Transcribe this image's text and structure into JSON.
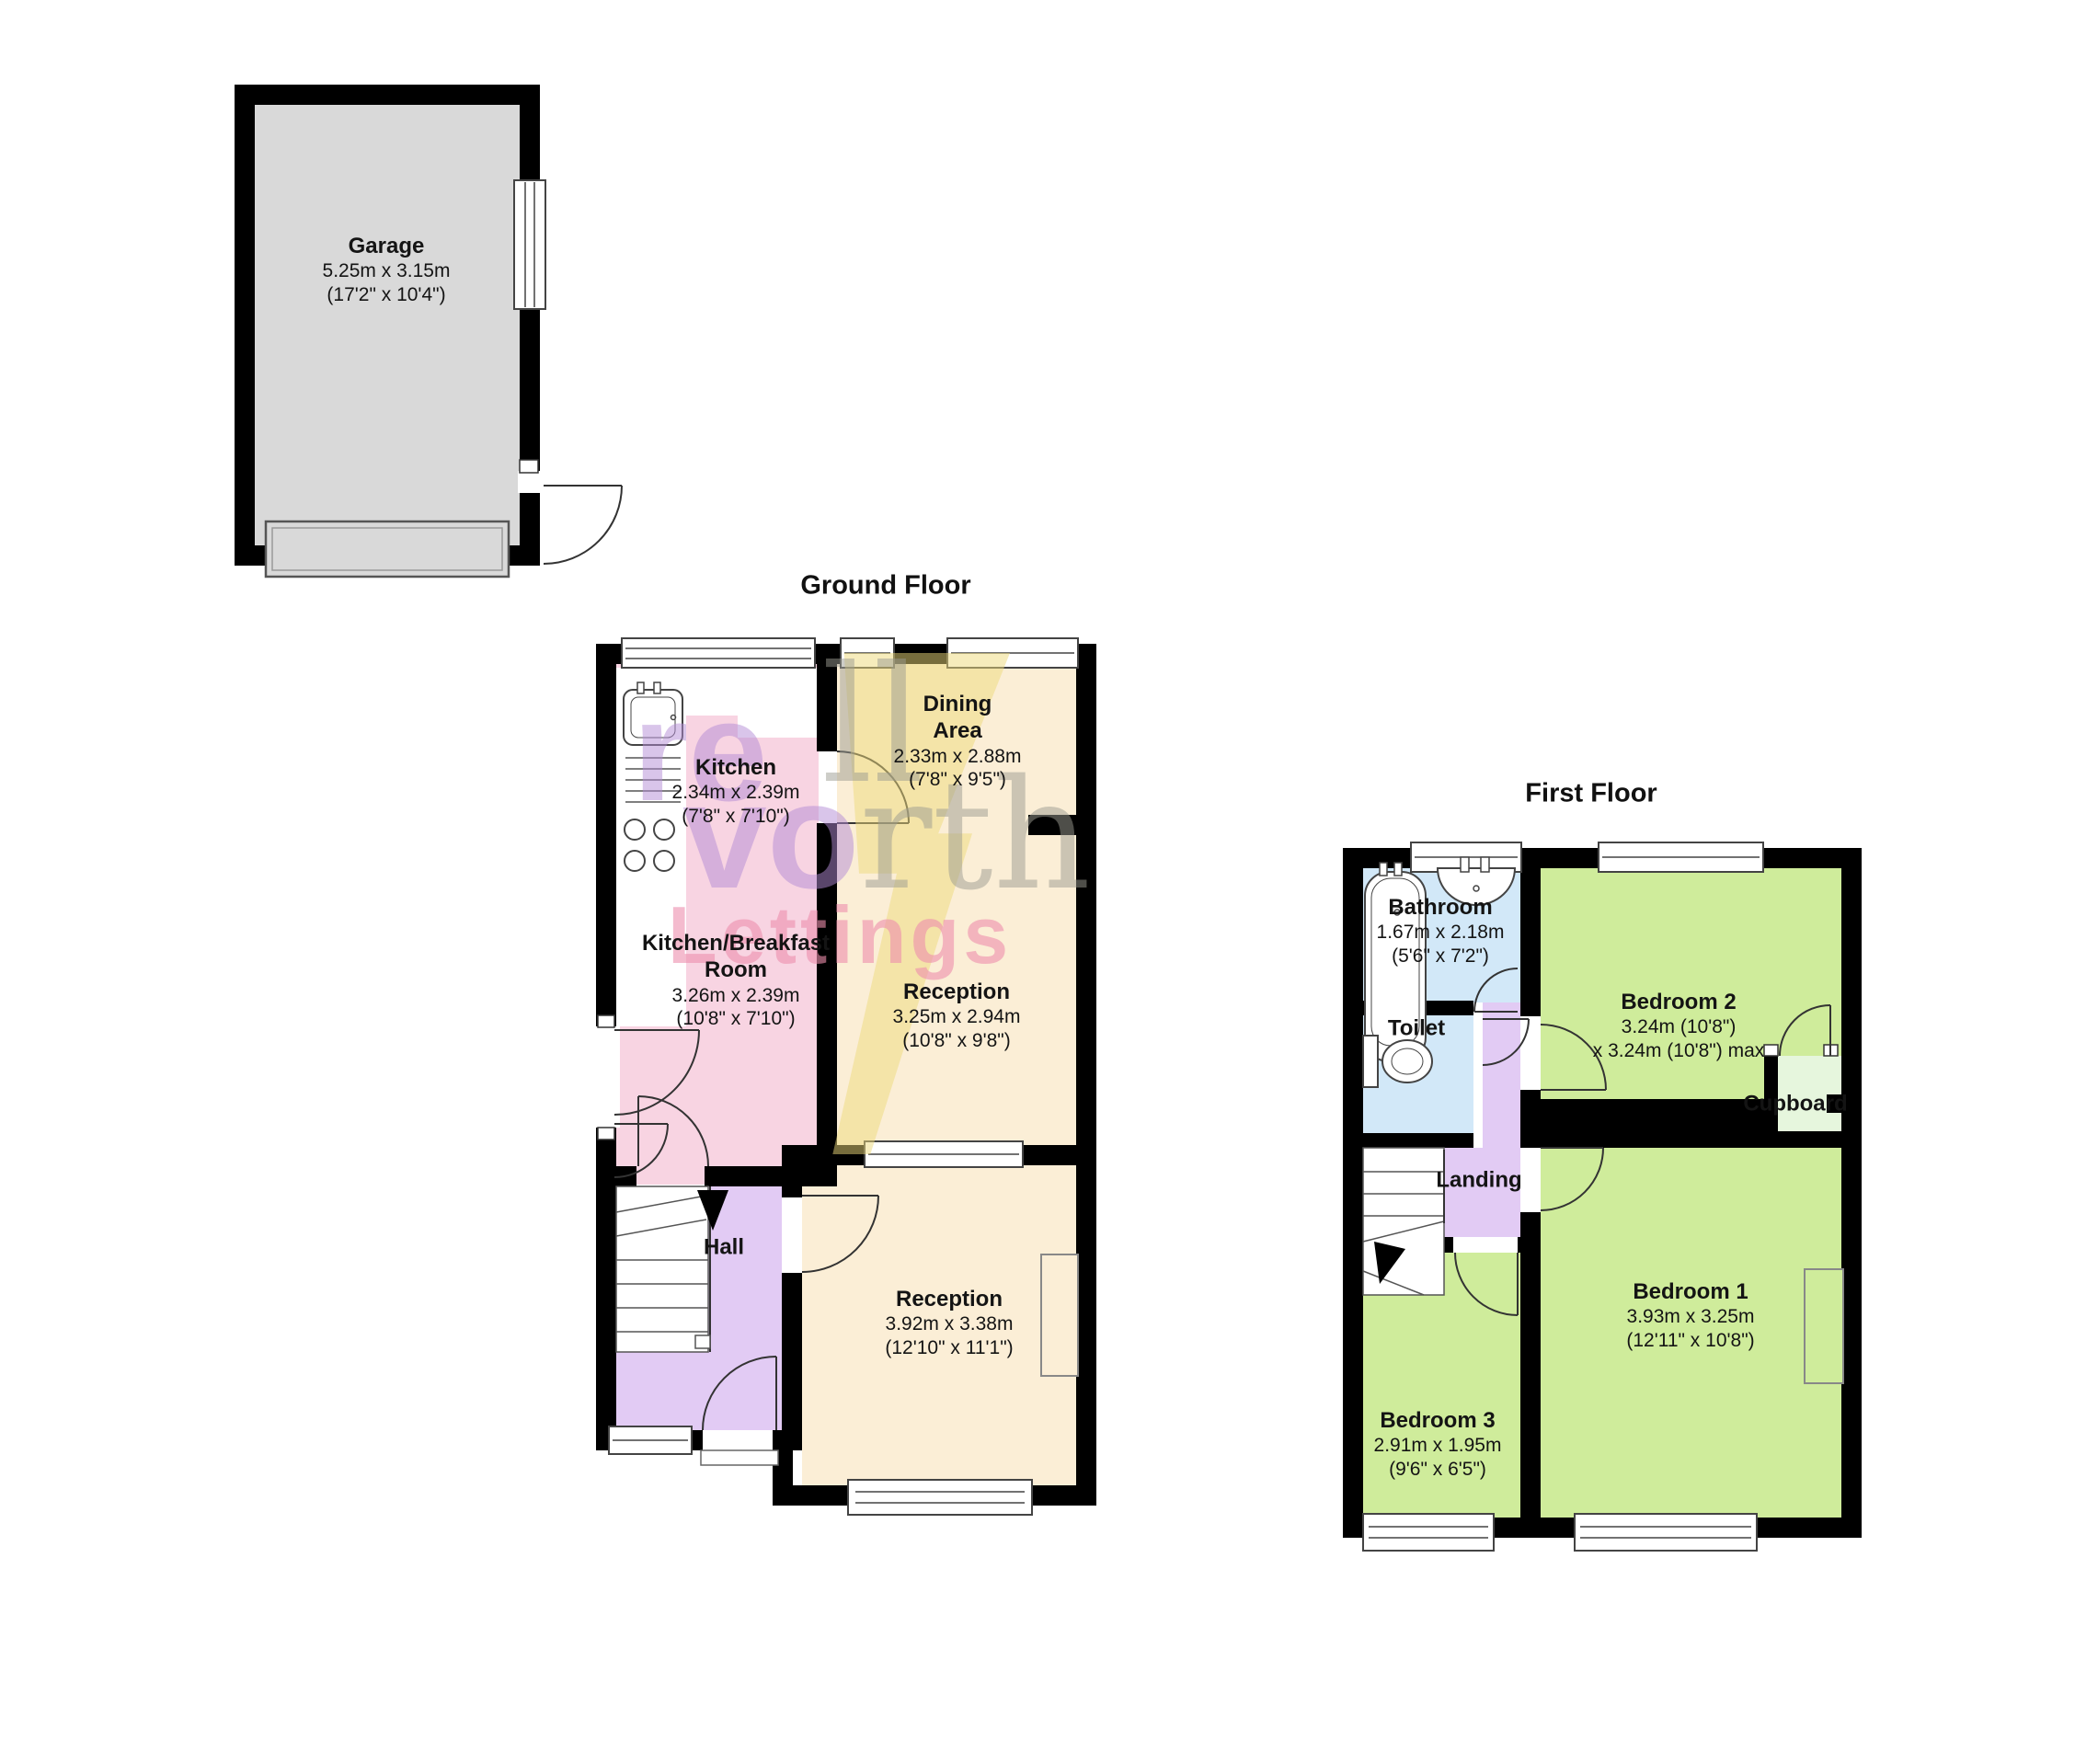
{
  "garage": {
    "name": "Garage",
    "metric": "5.25m x 3.15m",
    "imperial": "(17'2\" x 10'4\")"
  },
  "ground": {
    "title": "Ground Floor",
    "kitchen": {
      "name": "Kitchen",
      "metric": "2.34m x 2.39m",
      "imperial": "(7'8\" x 7'10\")"
    },
    "dining": {
      "line1": "Dining",
      "line2": "Area",
      "metric": "2.33m x 2.88m",
      "imperial": "(7'8\" x 9'5\")"
    },
    "kbr": {
      "line1": "Kitchen/Breakfast",
      "line2": "Room",
      "metric": "3.26m x 2.39m",
      "imperial": "(10'8\" x 7'10\")"
    },
    "reception1": {
      "name": "Reception",
      "metric": "3.25m x 2.94m",
      "imperial": "(10'8\" x 9'8\")"
    },
    "hall": {
      "name": "Hall"
    },
    "reception2": {
      "name": "Reception",
      "metric": "3.92m x 3.38m",
      "imperial": "(12'10\" x 11'1\")"
    }
  },
  "first": {
    "title": "First Floor",
    "bathroom": {
      "name": "Bathroom",
      "metric": "1.67m x 2.18m",
      "imperial": "(5'6\" x 7'2\")"
    },
    "toilet": {
      "name": "Toilet"
    },
    "landing": {
      "name": "Landing"
    },
    "bedroom2": {
      "name": "Bedroom 2",
      "metric": "3.24m (10'8\")",
      "imperial": "x 3.24m (10'8\") max"
    },
    "cupboard": {
      "name": "Cupboard"
    },
    "bedroom1": {
      "name": "Bedroom 1",
      "metric": "3.93m x 3.25m",
      "imperial": "(12'11\" x 10'8\")"
    },
    "bedroom3": {
      "name": "Bedroom 3",
      "metric": "2.91m x 1.95m",
      "imperial": "(9'6\" x 6'5\")"
    }
  },
  "watermark": {
    "frag1": "re",
    "frag2": "ll",
    "frag3a": "vo",
    "frag3b": "rth",
    "frag4": "Lettings"
  },
  "colors": {
    "wall": "#000000",
    "garage_fill": "#d9d9d9",
    "cream": "#fbeed6",
    "pink": "#f8d4e2",
    "lavender": "#e2cbf4",
    "blue": "#d2e8f8",
    "green": "#cfec9b",
    "cupboard": "#e6f6dd",
    "wm_purple": "#b48cd6",
    "wm_gray": "#9c9c92",
    "wm_pink": "#ee8fae",
    "wm_yellow": "#eeda79"
  }
}
